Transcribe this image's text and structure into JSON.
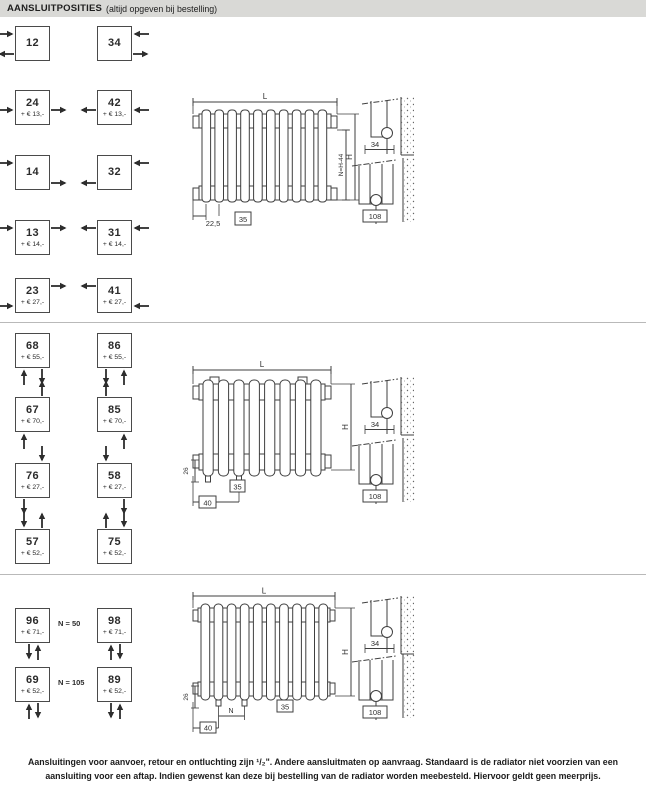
{
  "header": {
    "title": "AANSLUITPOSITIES",
    "subtitle": "(altijd opgeven bij bestelling)"
  },
  "sections": [
    {
      "name": "section-1",
      "boxes": [
        {
          "code": "12",
          "price": "",
          "arrows": [
            "left-top:right",
            "left-bottom:left"
          ]
        },
        {
          "code": "34",
          "price": "",
          "arrows": [
            "right-top:left",
            "right-bottom:right"
          ]
        },
        {
          "code": "24",
          "price": "+ € 13,-",
          "arrows": [
            "left-mid:right",
            "right-mid:right"
          ]
        },
        {
          "code": "42",
          "price": "+ € 13,-",
          "arrows": [
            "right-mid:left",
            "left-mid:left"
          ]
        },
        {
          "code": "14",
          "price": "",
          "arrows": [
            "left-top:right",
            "right-bottom:right"
          ]
        },
        {
          "code": "32",
          "price": "",
          "arrows": [
            "right-top:left",
            "left-bottom:left"
          ]
        },
        {
          "code": "13",
          "price": "+ € 14,-",
          "arrows": [
            "left-top:right",
            "right-top:right"
          ]
        },
        {
          "code": "31",
          "price": "+ € 14,-",
          "arrows": [
            "right-top:left",
            "left-top:left"
          ]
        },
        {
          "code": "23",
          "price": "+ € 27,-",
          "arrows": [
            "left-bottom:right",
            "right-top:right"
          ]
        },
        {
          "code": "41",
          "price": "+ € 27,-",
          "arrows": [
            "right-bottom:left",
            "left-top:left"
          ]
        }
      ],
      "drawing": {
        "dim_length": "L",
        "dim_n": "N=H-44",
        "dim_height": "H",
        "dim_a": "22,5",
        "dim_b": "35"
      },
      "wall_details": [
        {
          "dim": "34"
        },
        {
          "dim": "108"
        }
      ]
    },
    {
      "name": "section-2",
      "boxes": [
        {
          "code": "68",
          "price": "+ € 55,-",
          "arrows": [
            "below-left:up",
            "below-right:down"
          ]
        },
        {
          "code": "86",
          "price": "+ € 55,-",
          "arrows": [
            "below-left:down",
            "below-right:up"
          ]
        },
        {
          "code": "67",
          "price": "+ € 70,-",
          "arrows": [
            "above-right:up",
            "below-left:up"
          ]
        },
        {
          "code": "85",
          "price": "+ € 70,-",
          "arrows": [
            "above-left:up",
            "below-right:up"
          ]
        },
        {
          "code": "76",
          "price": "+ € 27,-",
          "arrows": [
            "above-right:down",
            "below-left:down"
          ]
        },
        {
          "code": "58",
          "price": "+ € 27,-",
          "arrows": [
            "above-left:down",
            "below-right:down"
          ]
        },
        {
          "code": "57",
          "price": "+ € 52,-",
          "arrows": [
            "above-left:down",
            "above-right:up"
          ]
        },
        {
          "code": "75",
          "price": "+ € 52,-",
          "arrows": [
            "above-left:up",
            "above-right:down"
          ]
        }
      ],
      "drawing": {
        "dim_length": "L",
        "dim_height": "H",
        "dim_a": "26",
        "dim_b": "40",
        "dim_c": "35"
      },
      "wall_details": [
        {
          "dim": "34"
        },
        {
          "dim": "108"
        }
      ]
    },
    {
      "name": "section-3",
      "notes": [
        {
          "label": "N = 50"
        },
        {
          "label": "N = 105"
        }
      ],
      "boxes": [
        {
          "code": "96",
          "price": "+ € 71,-",
          "arrows": [
            "pair-left:down",
            "pair-right:up"
          ]
        },
        {
          "code": "98",
          "price": "+ € 71,-",
          "arrows": [
            "pair-left:up",
            "pair-right:down"
          ]
        },
        {
          "code": "69",
          "price": "+ € 52,-",
          "arrows": [
            "pair-left:up",
            "pair-right:down"
          ]
        },
        {
          "code": "89",
          "price": "+ € 52,-",
          "arrows": [
            "pair-left:down",
            "pair-right:up"
          ]
        }
      ],
      "drawing": {
        "dim_length": "L",
        "dim_height": "H",
        "dim_a": "26",
        "dim_b": "40",
        "dim_n": "N",
        "dim_c": "35"
      },
      "wall_details": [
        {
          "dim": "34"
        },
        {
          "dim": "108"
        }
      ]
    }
  ],
  "footer": {
    "text": "Aansluitingen voor aanvoer, retour en ontluchting zijn ¹/₂\". Andere aansluitmaten op aanvraag. Standaard is de radiator niet voorzien van een aansluiting voor een aftap. Indien gewenst kan deze bij bestelling van de radiator worden meebesteld. Hiervoor geldt geen meerprijs."
  },
  "colors": {
    "header_bar": "#d9d9d6",
    "line_art": "#3f3f3f",
    "text": "#2b2b2b"
  }
}
